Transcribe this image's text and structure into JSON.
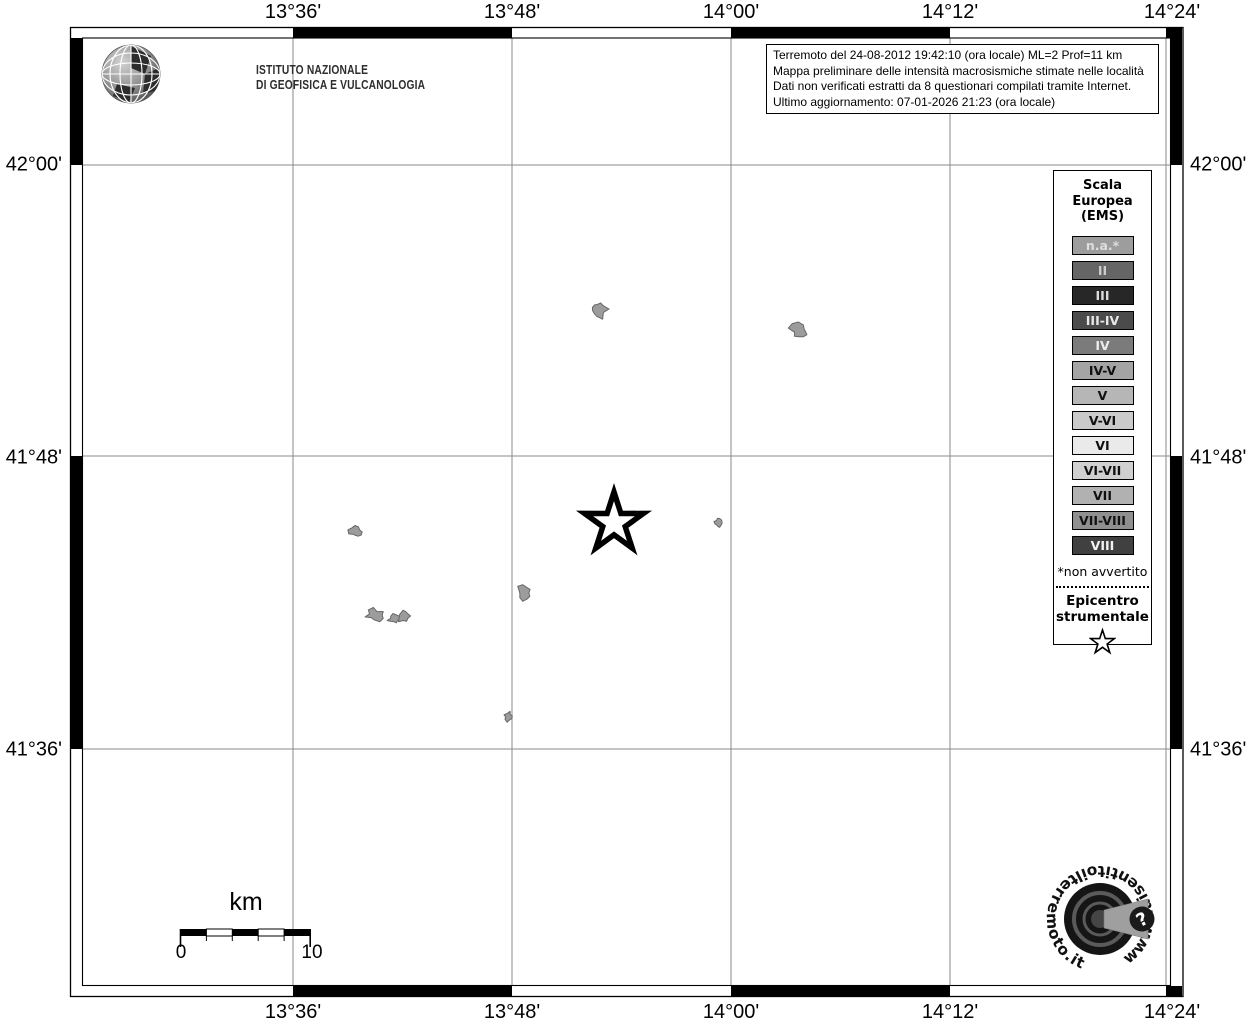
{
  "header": {
    "ingv_line1": "ISTITUTO NAZIONALE",
    "ingv_line2": "DI GEOFISICA E VULCANOLOGIA"
  },
  "title_box": {
    "lines": [
      "Terremoto del 24-08-2012 19:42:10 (ora locale) ML=2 Prof=11 km",
      "Mappa preliminare delle intensità macrosismiche stimate nelle località",
      "Dati non verificati estratti da 8 questionari compilati tramite Internet.",
      "Ultimo aggiornamento: 07-01-2026 21:23 (ora locale)"
    ]
  },
  "axes": {
    "top": [
      "13°36'",
      "13°48'",
      "14°00'",
      "14°12'",
      "14°24'"
    ],
    "bottom": [
      "13°36'",
      "13°48'",
      "14°00'",
      "14°12'",
      "14°24'"
    ],
    "left": [
      "42°00'",
      "41°48'",
      "41°36'"
    ],
    "right": [
      "42°00'",
      "41°48'",
      "41°36'"
    ]
  },
  "legend": {
    "title_lines": [
      "Scala",
      "Europea",
      "(EMS)"
    ],
    "items": [
      {
        "label": "n.a.*",
        "bg": "#9d9d9d",
        "fg": "#dedede"
      },
      {
        "label": "II",
        "bg": "#656565",
        "fg": "#cdcdcd"
      },
      {
        "label": "III",
        "bg": "#272727",
        "fg": "#dddddd"
      },
      {
        "label": "III-IV",
        "bg": "#4b4b4b",
        "fg": "#e8e8e8"
      },
      {
        "label": "IV",
        "bg": "#7b7b7b",
        "fg": "#ececec"
      },
      {
        "label": "IV-V",
        "bg": "#a4a4a4",
        "fg": "#111111"
      },
      {
        "label": "V",
        "bg": "#b6b6b6",
        "fg": "#111111"
      },
      {
        "label": "V-VI",
        "bg": "#cacaca",
        "fg": "#111111"
      },
      {
        "label": "VI",
        "bg": "#eaeaea",
        "fg": "#111111"
      },
      {
        "label": "VI-VII",
        "bg": "#d0d0d0",
        "fg": "#111111"
      },
      {
        "label": "VII",
        "bg": "#b1b1b1",
        "fg": "#111111"
      },
      {
        "label": "VII-VIII",
        "bg": "#8f8f8f",
        "fg": "#111111"
      },
      {
        "label": "VIII",
        "bg": "#404040",
        "fg": "#f2f2f2"
      }
    ],
    "footnote": "*non avvertito",
    "epicenter_line1": "Epicentro",
    "epicenter_line2": "strumentale"
  },
  "scalebar": {
    "unit": "km",
    "start": "0",
    "end": "10"
  },
  "map": {
    "epicenter": {
      "x": 614,
      "y": 523
    },
    "localities": [
      {
        "x": 598,
        "y": 309,
        "s": 9,
        "sx": 1.0
      },
      {
        "x": 800,
        "y": 331,
        "s": 8,
        "sx": 1.2
      },
      {
        "x": 356,
        "y": 532,
        "s": 6,
        "sx": 1.1
      },
      {
        "x": 375,
        "y": 615,
        "s": 6,
        "sx": 1.5
      },
      {
        "x": 394,
        "y": 619,
        "s": 4.5,
        "sx": 1.4
      },
      {
        "x": 404,
        "y": 616,
        "s": 6,
        "sx": 1.1
      },
      {
        "x": 524,
        "y": 593,
        "s": 7,
        "sx": 1.1
      },
      {
        "x": 718,
        "y": 523,
        "s": 5,
        "sx": 0.8
      },
      {
        "x": 508,
        "y": 716,
        "s": 5,
        "sx": 1.0
      }
    ],
    "colors": {
      "locality_fill": "#9c9c9c",
      "locality_stroke": "#676767",
      "grid": "#8a8a8a"
    }
  },
  "logo_bottom": {
    "circular_text": "www.haisentitoilterremoto.it",
    "question_mark": "?"
  }
}
